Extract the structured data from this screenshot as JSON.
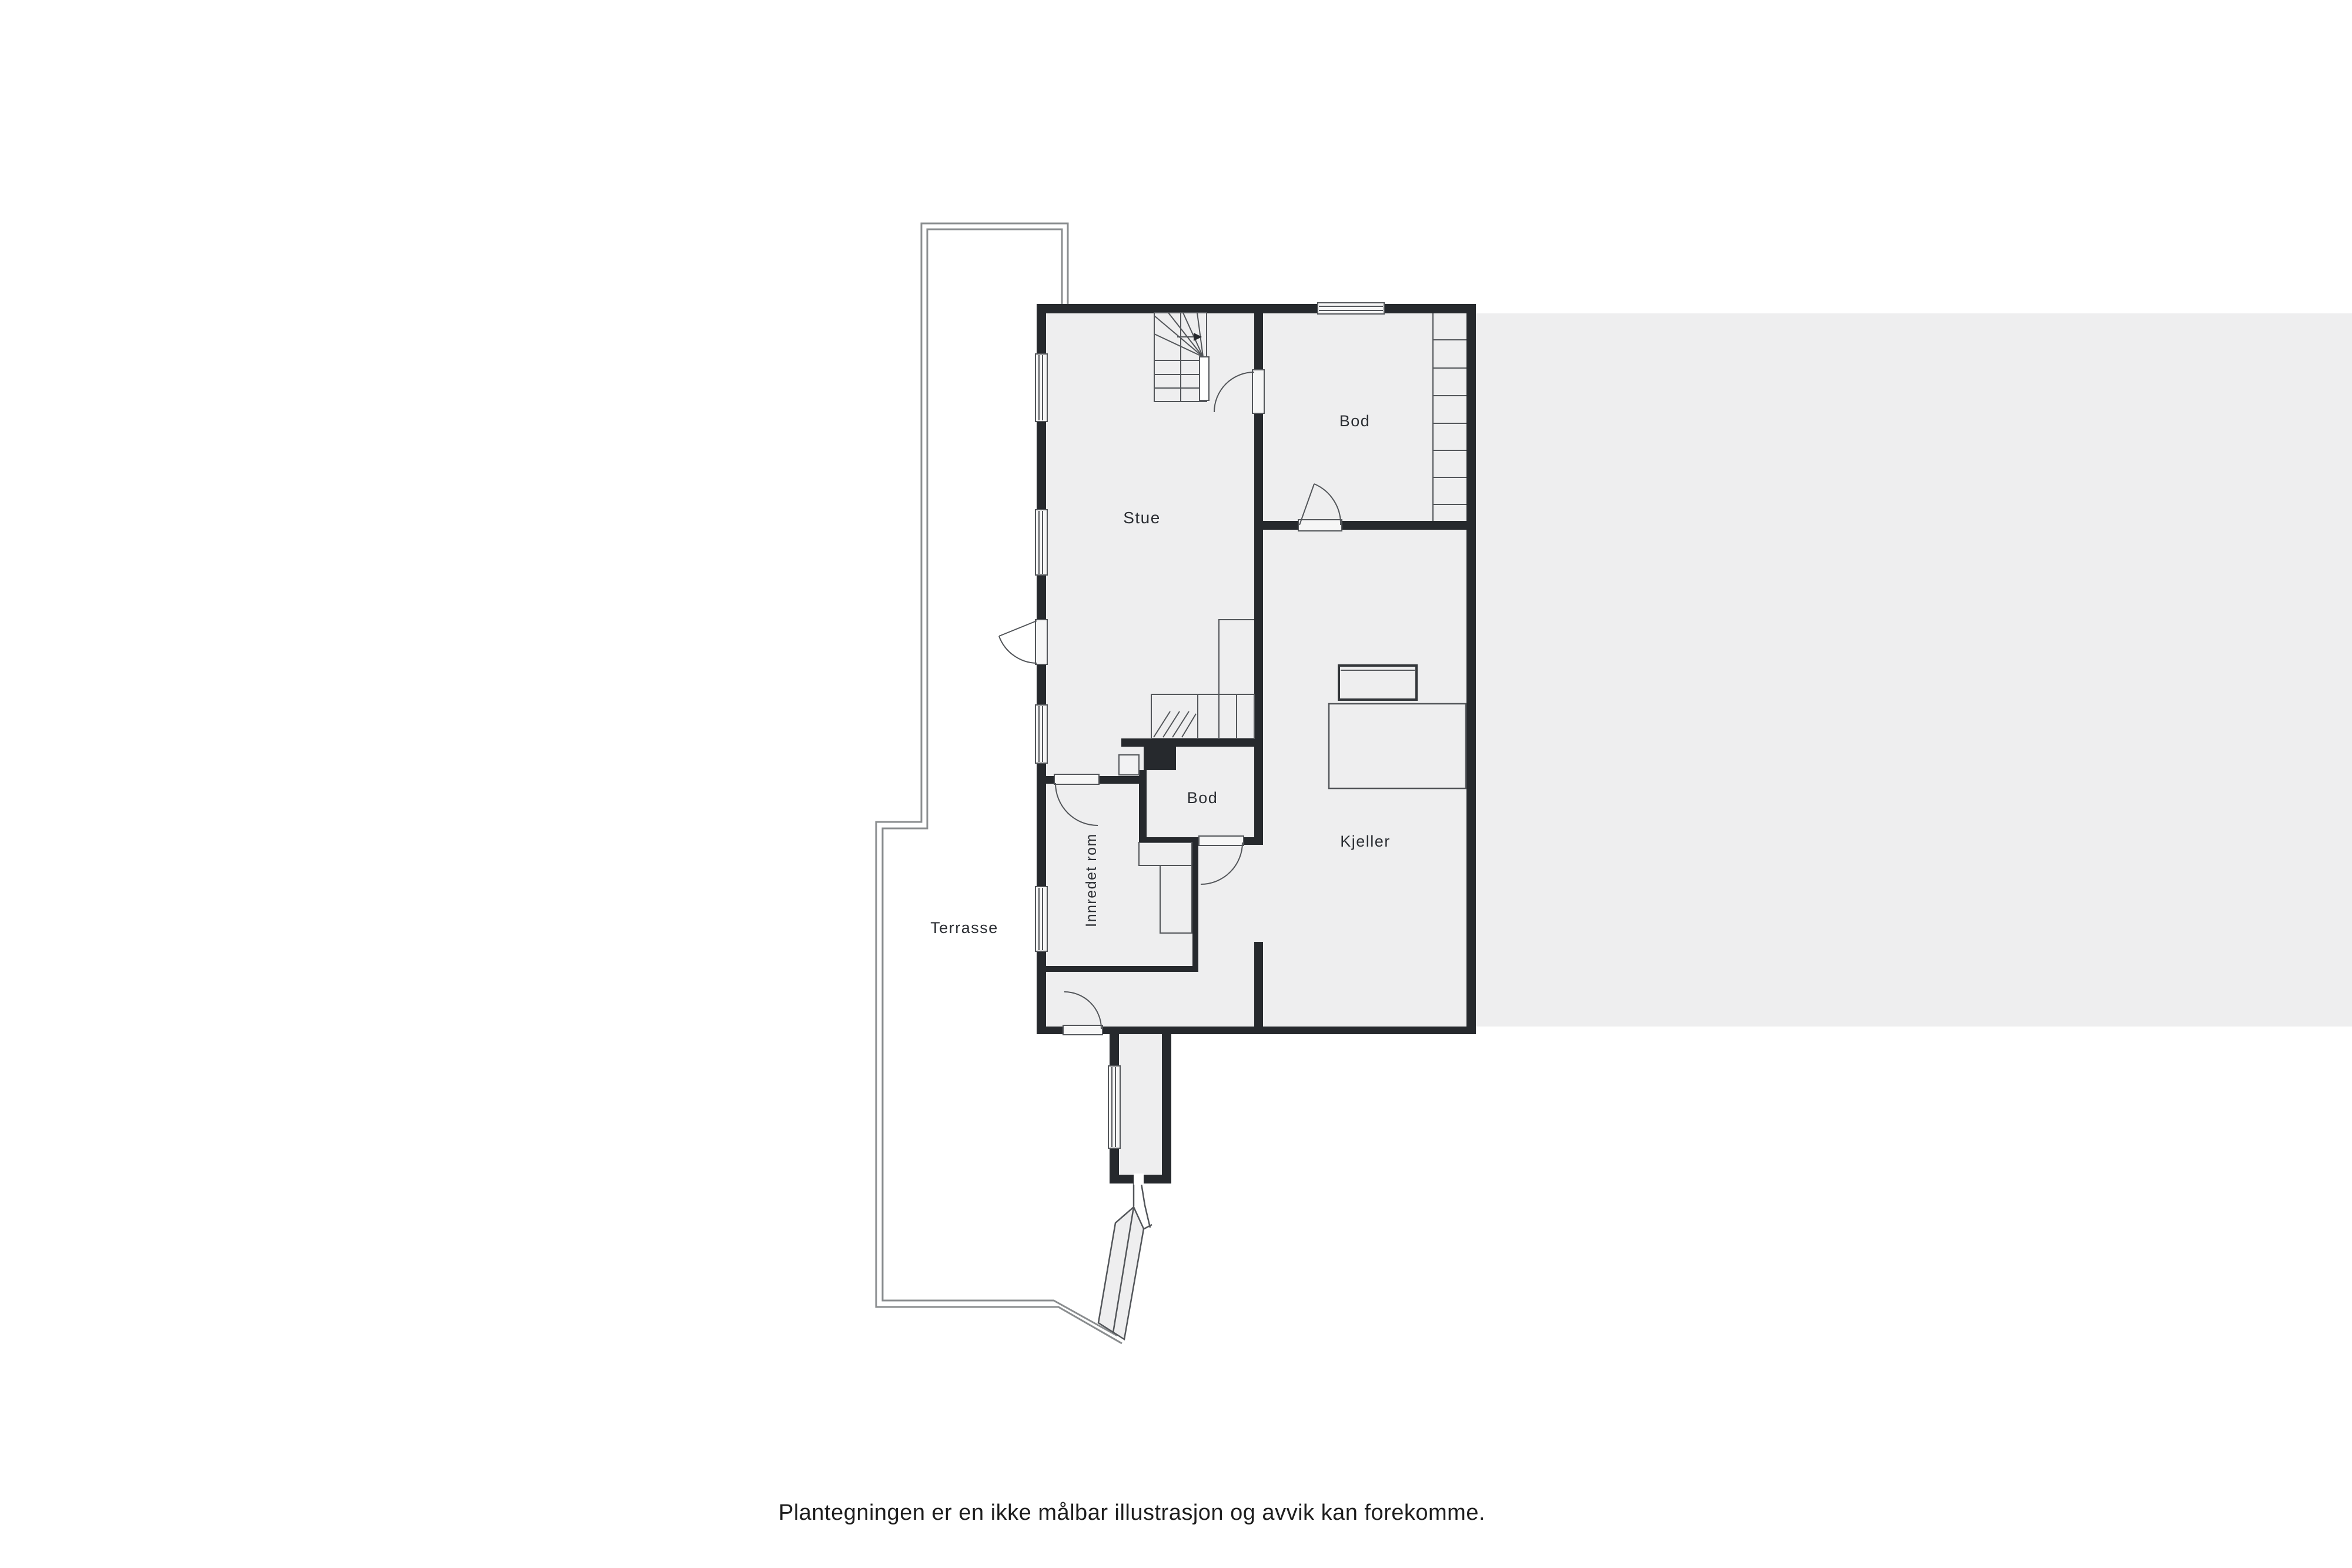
{
  "floorplan": {
    "rooms": {
      "stue": {
        "label": "Stue"
      },
      "bod_top": {
        "label": "Bod"
      },
      "kjeller": {
        "label": "Kjeller"
      },
      "bod_small": {
        "label": "Bod"
      },
      "innredet_rom": {
        "label": "Innredet rom"
      },
      "terrasse": {
        "label": "Terrasse"
      }
    },
    "caption": {
      "text": "Plantegningen er en ikke målbar illustrasjon og avvik kan forekomme."
    },
    "colors": {
      "wall": "#26292d",
      "floor": "#eeeeef",
      "line": "#53565a",
      "terrace_line": "#8a8d8f",
      "background": "#ffffff"
    }
  }
}
